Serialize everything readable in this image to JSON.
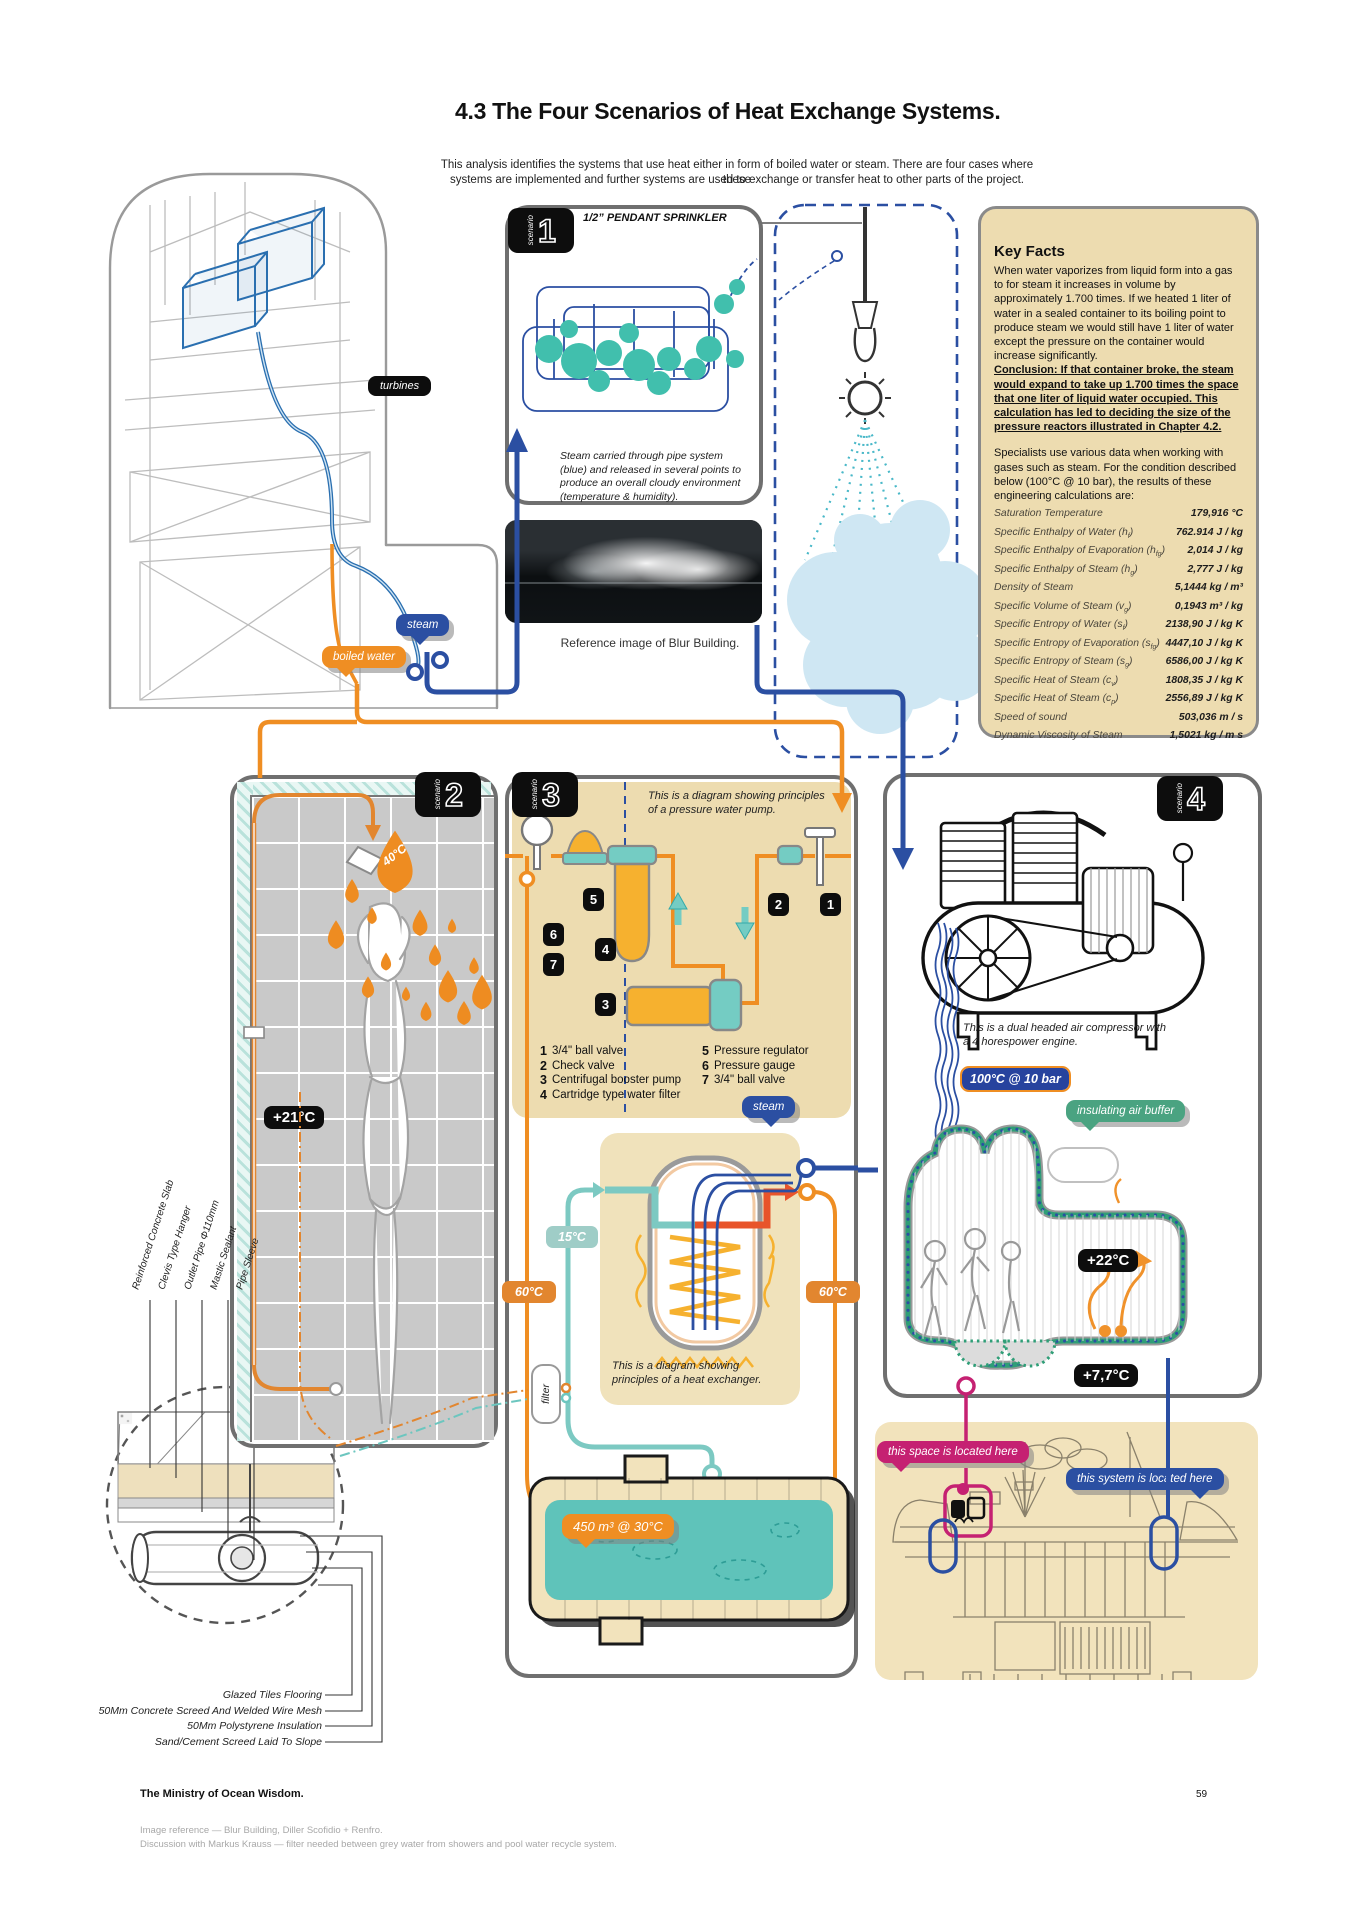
{
  "header": {
    "title": "4.3 The Four Scenarios of Heat Exchange Systems.",
    "intro1": "This analysis identifies the systems that use heat either in form of boiled water or steam. There are four cases where these",
    "intro2": "systems are implemented and further systems are used to exchange or transfer heat to other parts of the project."
  },
  "tower": {
    "turbines": "turbines",
    "steam": "steam",
    "boiled_water": "boiled water"
  },
  "s1": {
    "badge_word": "scenario",
    "badge_num": "1",
    "sprinkler": "1/2” PENDANT SPRINKLER",
    "caption": "Steam carried through pipe system (blue) and released in several points to produce an overall cloudy environment (temperature & humidity).",
    "photo_caption": "Reference image of Blur Building."
  },
  "key_facts": {
    "title": "Key Facts",
    "para1": "When water vaporizes from liquid form into a gas to for steam it increases in volume by approximately 1.700 times. If we heated 1 liter of water in a sealed container to its boiling point to produce steam we would still have 1 liter of water except the pressure on the container would increase significantly.",
    "conclusion": "Conclusion: If that container broke, the steam would expand to take up 1.700 times the space that one liter of liquid water occupied. This calculation has led to deciding the size of the pressure reactors illustrated in Chapter 4.2.",
    "para2": "Specialists use various data when working with gases such as steam. For the condition described below (100°C @ 10 bar), the results of these engineering calculations are:",
    "table": [
      {
        "pre": "Saturation Temperature",
        "sub": "",
        "post": "",
        "value": "179,916 °C"
      },
      {
        "pre": "Specific Enthalpy of Water (h",
        "sub": "f",
        "post": ")",
        "value": "762.914 J / kg"
      },
      {
        "pre": "Specific Enthalpy of Evaporation (h",
        "sub": "fg",
        "post": ")",
        "value": "2,014 J / kg"
      },
      {
        "pre": "Specific Enthalpy of Steam (h",
        "sub": "g",
        "post": ")",
        "value": "2,777 J / kg"
      },
      {
        "pre": "Density of Steam",
        "sub": "",
        "post": "",
        "value": "5,1444 kg / m³"
      },
      {
        "pre": "Specific Volume of Steam (v",
        "sub": "g",
        "post": ")",
        "value": "0,1943 m³ / kg"
      },
      {
        "pre": "Specific Entropy of Water (s",
        "sub": "f",
        "post": ")",
        "value": "2138,90 J / kg K"
      },
      {
        "pre": "Specific Entropy of Evaporation (s",
        "sub": "fg",
        "post": ")",
        "value": "4447,10 J / kg K"
      },
      {
        "pre": "Specific Entropy of Steam (s",
        "sub": "g",
        "post": ")",
        "value": "6586,00 J / kg K"
      },
      {
        "pre": "Specific Heat of Steam (c",
        "sub": "v",
        "post": ")",
        "value": "1808,35 J / kg K"
      },
      {
        "pre": "Specific Heat of Steam (c",
        "sub": "p",
        "post": ")",
        "value": "2556,89 J / kg K"
      },
      {
        "pre": "Speed of sound",
        "sub": "",
        "post": "",
        "value": "503,036 m / s"
      },
      {
        "pre": "Dynamic Viscosity of Steam",
        "sub": "",
        "post": "",
        "value": "1,5021 kg / m s"
      }
    ]
  },
  "s2": {
    "badge_word": "scenario",
    "badge_num": "2",
    "droplet_temp": "40°C",
    "room_temp": "+21°C"
  },
  "s3": {
    "badge_word": "scenario",
    "badge_num": "3",
    "pump_caption": "This is a diagram showing principles of a pressure water pump.",
    "legend_col1": [
      {
        "n": "1",
        "t": "3/4\" ball valve"
      },
      {
        "n": "2",
        "t": "Check valve"
      },
      {
        "n": "3",
        "t": "Centrifugal booster pump"
      },
      {
        "n": "4",
        "t": "Cartridge type water filter"
      }
    ],
    "legend_col2": [
      {
        "n": "5",
        "t": "Pressure regulator"
      },
      {
        "n": "6",
        "t": "Pressure gauge"
      },
      {
        "n": "7",
        "t": "3/4\" ball valve"
      }
    ],
    "steam": "steam",
    "cold": "15°C",
    "hot_left": "60°C",
    "hot_right": "60°C",
    "filter": "filter",
    "hx_caption": "This is a diagram showing principles of a heat exchanger.",
    "pool": "450 m³ @ 30°C"
  },
  "s4": {
    "badge_word": "scenario",
    "badge_num": "4",
    "caption": "This is a dual headed air compressor with a 4 horespower engine.",
    "condition": "100°C @ 10 bar",
    "buffer": "insulating air buffer",
    "inside_temp": "+22°C",
    "outside_temp": "+7,7°C"
  },
  "location": {
    "space": "this space is located here",
    "system": "this system is located here"
  },
  "floor": {
    "left_labels": [
      {
        "label": "Reinforced Concrete Slab"
      },
      {
        "label": "Clevis Type Hanger"
      },
      {
        "label": "Outlet Pipe Φ110mm"
      },
      {
        "label": "Mastic Sealant"
      },
      {
        "label": "Pipe Sleeve"
      }
    ],
    "bottom_labels": [
      {
        "label": "Glazed Tiles Flooring"
      },
      {
        "label": "50Mm Concrete Screed And Welded Wire Mesh"
      },
      {
        "label": "50Mm Polystyrene Insulation"
      },
      {
        "label": "Sand/Cement Screed Laid To Slope"
      }
    ]
  },
  "footer": {
    "publisher": "The Ministry of Ocean Wisdom.",
    "page": "59",
    "ref1": "Image reference — Blur Building, Diller Scofidio + Renfro.",
    "ref2": "Discussion with Markus Krauss — filter needed between grey water from showers and pool water recycle system."
  },
  "colors": {
    "accent_blue": "#2b4fa2",
    "accent_orange": "#ef8e23",
    "accent_teal": "#41bfad",
    "beige": "#eddcb0",
    "green": "#4aa381",
    "magenta": "#c52172"
  }
}
